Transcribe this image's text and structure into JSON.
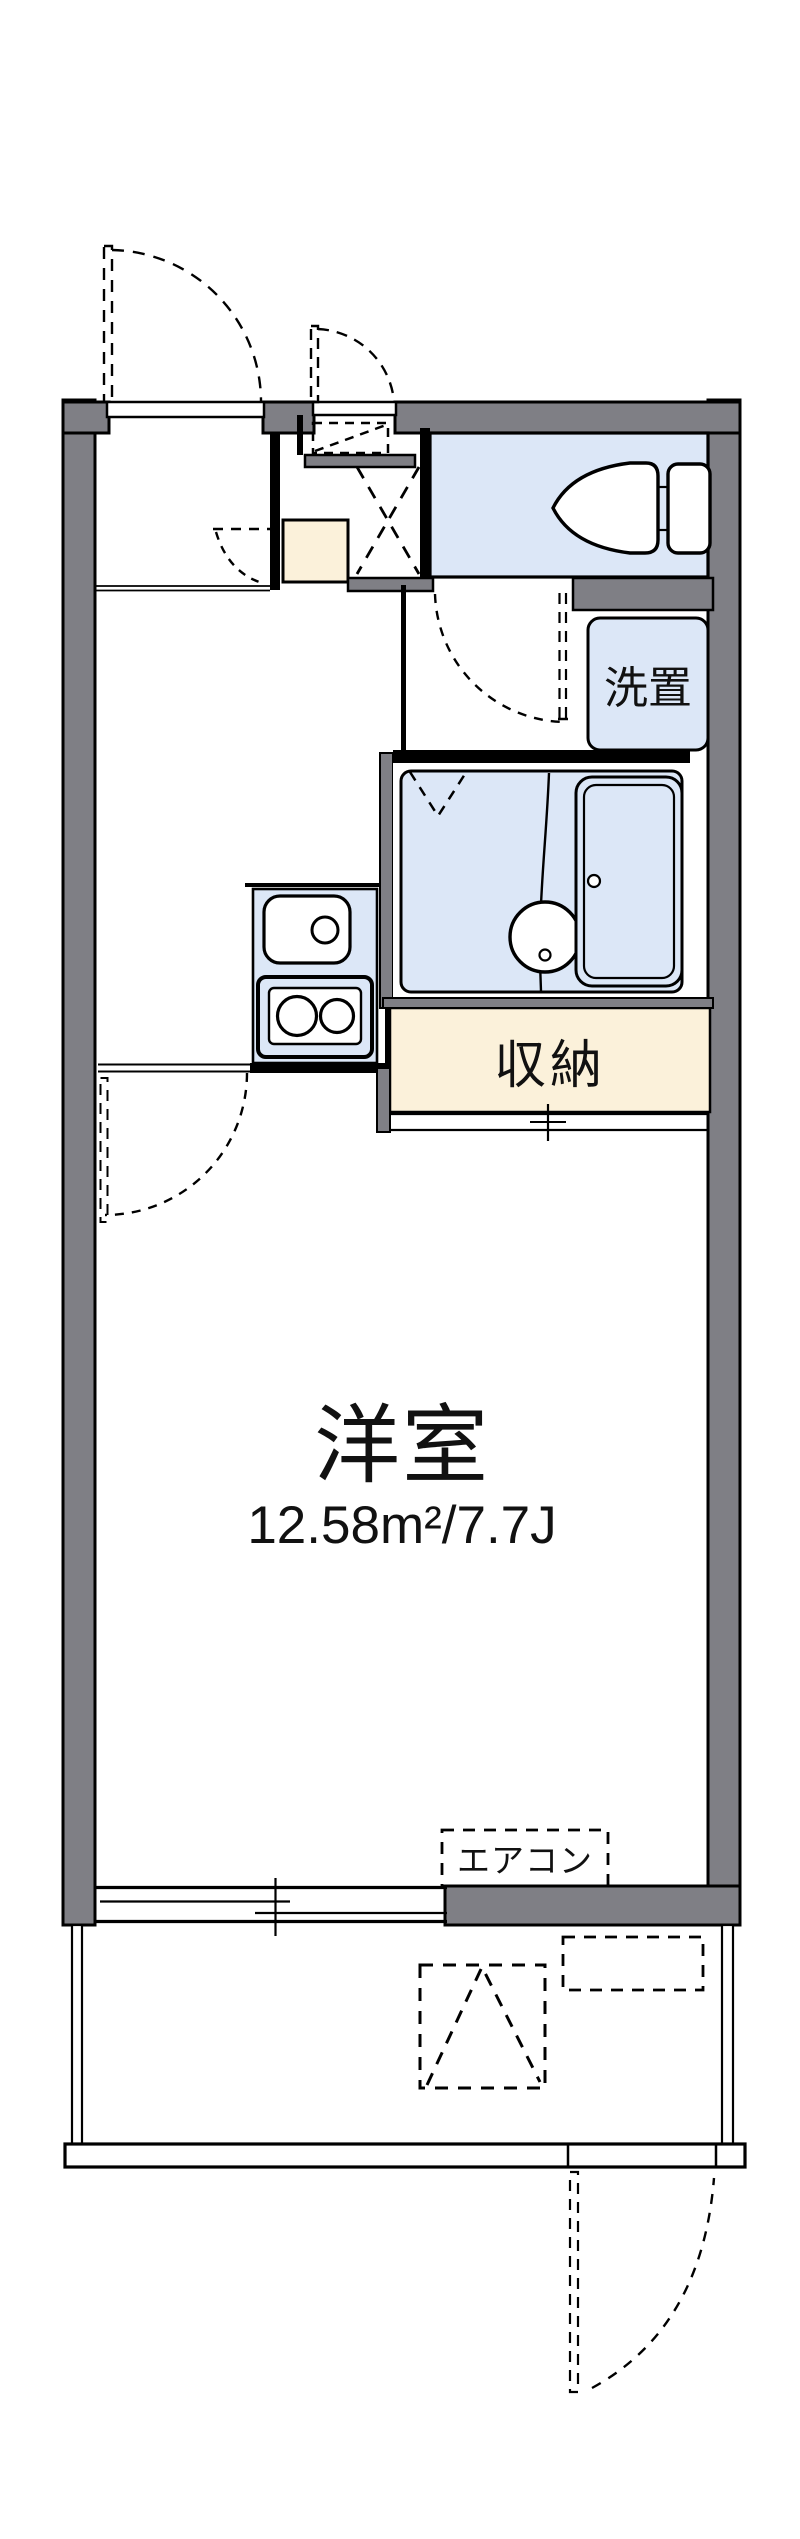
{
  "floorplan": {
    "type": "japanese-apartment-1K-floorplan",
    "labels": {
      "main_room": "洋室",
      "main_room_area": "12.58m²/7.7J",
      "storage": "収納",
      "washer": "洗置",
      "aircon": "エアコン"
    },
    "colors": {
      "wall": "#7f7f85",
      "water": "#dce7f7",
      "storage": "#fbf1da",
      "line": "#000000",
      "bg": "#ffffff"
    },
    "fixtures": [
      "entrance-door",
      "hall-door",
      "room-door",
      "washroom-door",
      "toilet",
      "toilet-tank",
      "bathtub",
      "shower-stool",
      "bath-folding-door",
      "kitchen-sink",
      "gas-stove",
      "washer-space",
      "storage-closet",
      "shoe-box",
      "overhead-shelf",
      "air-conditioner",
      "sliding-window",
      "balcony",
      "balcony-gate",
      "water-heater"
    ]
  }
}
